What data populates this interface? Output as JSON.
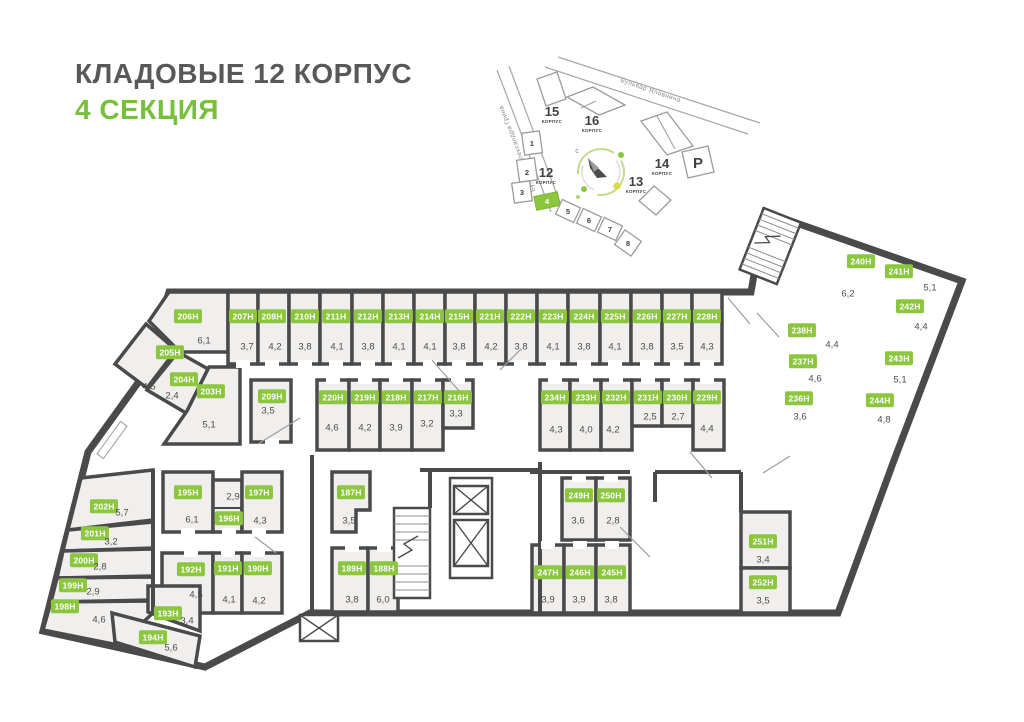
{
  "header": {
    "title": "КЛАДОВЫЕ 12 КОРПУС",
    "subtitle": "4 СЕКЦИЯ"
  },
  "colors": {
    "accent_green": "#8cc63f",
    "wall": "#4a4a4a",
    "room_fill": "#f1efed",
    "title_gray": "#57585a"
  },
  "site_map": {
    "streets": [
      {
        "name": "Бульвар Александра Грина"
      },
      {
        "name": "Бульвар Яловнина"
      }
    ],
    "buildings": [
      {
        "num": "15",
        "label": "КОРПУС"
      },
      {
        "num": "16",
        "label": "КОРПУС"
      },
      {
        "num": "14",
        "label": "КОРПУС"
      },
      {
        "num": "13",
        "label": "КОРПУС"
      },
      {
        "num": "12",
        "label": "КОРПУС"
      }
    ],
    "parking": "Р",
    "north": "с",
    "sections": [
      "1",
      "2",
      "3",
      "4",
      "5",
      "6",
      "7",
      "8"
    ],
    "active_section": "4"
  },
  "floorplan": {
    "rooms": [
      {
        "id": "206Н",
        "area": "6,1",
        "bx": 188,
        "by": 316,
        "ax": 204,
        "ay": 341,
        "poly": [
          [
            169,
            292
          ],
          [
            228,
            292
          ],
          [
            228,
            352
          ],
          [
            180,
            352
          ],
          [
            149,
            321
          ]
        ]
      },
      {
        "id": "207Н",
        "area": "3,7",
        "bx": 243,
        "by": 316,
        "ax": 247,
        "ay": 347,
        "rect": [
          228,
          292,
          30,
          72
        ],
        "door": "b"
      },
      {
        "id": "208Н",
        "area": "4,2",
        "bx": 272,
        "by": 316,
        "ax": 275,
        "ay": 347,
        "rect": [
          258,
          292,
          31,
          72
        ],
        "door": "b"
      },
      {
        "id": "210Н",
        "area": "3,8",
        "bx": 305,
        "by": 316,
        "ax": 305,
        "ay": 347,
        "rect": [
          289,
          292,
          31,
          72
        ],
        "door": "b"
      },
      {
        "id": "211Н",
        "area": "4,1",
        "bx": 336,
        "by": 316,
        "ax": 337,
        "ay": 347,
        "rect": [
          320,
          292,
          32,
          72
        ],
        "door": "b"
      },
      {
        "id": "212Н",
        "area": "3,8",
        "bx": 368,
        "by": 316,
        "ax": 368,
        "ay": 347,
        "rect": [
          352,
          292,
          31,
          72
        ],
        "door": "b"
      },
      {
        "id": "213Н",
        "area": "4,1",
        "bx": 399,
        "by": 316,
        "ax": 399,
        "ay": 347,
        "rect": [
          383,
          292,
          31,
          72
        ],
        "door": "b"
      },
      {
        "id": "214Н",
        "area": "4,1",
        "bx": 430,
        "by": 316,
        "ax": 430,
        "ay": 347,
        "rect": [
          414,
          292,
          31,
          72
        ],
        "door": "b"
      },
      {
        "id": "215Н",
        "area": "3,8",
        "bx": 459,
        "by": 316,
        "ax": 459,
        "ay": 347,
        "rect": [
          445,
          292,
          30,
          72
        ],
        "door": "b"
      },
      {
        "id": "221Н",
        "area": "4,2",
        "bx": 490,
        "by": 316,
        "ax": 491,
        "ay": 347,
        "rect": [
          475,
          292,
          31,
          72
        ],
        "door": "b"
      },
      {
        "id": "222Н",
        "area": "3,8",
        "bx": 521,
        "by": 316,
        "ax": 521,
        "ay": 347,
        "rect": [
          506,
          292,
          31,
          72
        ],
        "door": "b"
      },
      {
        "id": "223Н",
        "area": "4,1",
        "bx": 553,
        "by": 316,
        "ax": 553,
        "ay": 347,
        "rect": [
          537,
          292,
          31,
          72
        ],
        "door": "b"
      },
      {
        "id": "224Н",
        "area": "3,8",
        "bx": 584,
        "by": 316,
        "ax": 584,
        "ay": 347,
        "rect": [
          568,
          292,
          32,
          72
        ],
        "door": "b"
      },
      {
        "id": "225Н",
        "area": "4,1",
        "bx": 615,
        "by": 316,
        "ax": 615,
        "ay": 347,
        "rect": [
          600,
          292,
          31,
          72
        ],
        "door": "b"
      },
      {
        "id": "226Н",
        "area": "3,8",
        "bx": 647,
        "by": 316,
        "ax": 647,
        "ay": 347,
        "rect": [
          631,
          292,
          31,
          72
        ],
        "door": "b"
      },
      {
        "id": "227Н",
        "area": "3,5",
        "bx": 677,
        "by": 316,
        "ax": 677,
        "ay": 347,
        "rect": [
          662,
          292,
          30,
          72
        ],
        "door": "b"
      },
      {
        "id": "228Н",
        "area": "4,3",
        "bx": 707,
        "by": 316,
        "ax": 707,
        "ay": 347,
        "rect": [
          692,
          292,
          30,
          72
        ],
        "door": "b"
      },
      {
        "id": "205Н",
        "area": "4,5",
        "bx": 170,
        "by": 352,
        "ax": 149,
        "ay": 387,
        "poly": [
          [
            146,
            324
          ],
          [
            176,
            350
          ],
          [
            147,
            388
          ],
          [
            115,
            364
          ]
        ]
      },
      {
        "id": "204Н",
        "area": "2,4",
        "bx": 184,
        "by": 379,
        "ax": 172,
        "ay": 396,
        "poly": [
          [
            178,
            352
          ],
          [
            208,
            369
          ],
          [
            186,
            413
          ],
          [
            147,
            390
          ]
        ]
      },
      {
        "id": "203Н",
        "area": "5,1",
        "bx": 211,
        "by": 391,
        "ax": 209,
        "ay": 425,
        "poly": [
          [
            209,
            367
          ],
          [
            240,
            367
          ],
          [
            240,
            444
          ],
          [
            164,
            444
          ],
          [
            187,
            411
          ]
        ]
      },
      {
        "id": "209Н",
        "area": "3,5",
        "bx": 272,
        "by": 396,
        "ax": 268,
        "ay": 411,
        "rect": [
          251,
          380,
          40,
          62
        ],
        "door": "b"
      },
      {
        "id": "220Н",
        "area": "4,6",
        "bx": 333,
        "by": 397,
        "ax": 332,
        "ay": 428,
        "rect": [
          317,
          380,
          32,
          70
        ],
        "door": "t"
      },
      {
        "id": "219Н",
        "area": "4,2",
        "bx": 365,
        "by": 397,
        "ax": 365,
        "ay": 428,
        "rect": [
          349,
          380,
          31,
          70
        ],
        "door": "t"
      },
      {
        "id": "218Н",
        "area": "3,9",
        "bx": 396,
        "by": 397,
        "ax": 396,
        "ay": 428,
        "rect": [
          380,
          380,
          32,
          70
        ],
        "door": "t"
      },
      {
        "id": "217Н",
        "area": "3,2",
        "bx": 428,
        "by": 397,
        "ax": 427,
        "ay": 424,
        "rect": [
          412,
          380,
          31,
          70
        ],
        "door": "t"
      },
      {
        "id": "216Н",
        "area": "3,3",
        "bx": 458,
        "by": 397,
        "ax": 456,
        "ay": 414,
        "rect": [
          443,
          380,
          30,
          48
        ],
        "door": "t"
      },
      {
        "id": "234Н",
        "area": "4,3",
        "bx": 555,
        "by": 397,
        "ax": 556,
        "ay": 430,
        "rect": [
          540,
          380,
          30,
          70
        ],
        "door": "t"
      },
      {
        "id": "233Н",
        "area": "4,0",
        "bx": 586,
        "by": 397,
        "ax": 586,
        "ay": 430,
        "rect": [
          570,
          380,
          31,
          70
        ],
        "door": "t"
      },
      {
        "id": "232Н",
        "area": "4,2",
        "bx": 616,
        "by": 397,
        "ax": 613,
        "ay": 430,
        "rect": [
          601,
          380,
          31,
          70
        ],
        "door": "t"
      },
      {
        "id": "231Н",
        "area": "2,5",
        "bx": 648,
        "by": 397,
        "ax": 650,
        "ay": 417,
        "rect": [
          632,
          380,
          30,
          46
        ],
        "door": "t"
      },
      {
        "id": "230Н",
        "area": "2,7",
        "bx": 677,
        "by": 397,
        "ax": 678,
        "ay": 417,
        "rect": [
          662,
          380,
          31,
          46
        ],
        "door": "t"
      },
      {
        "id": "229Н",
        "area": "4,4",
        "bx": 707,
        "by": 397,
        "ax": 707,
        "ay": 429,
        "rect": [
          693,
          380,
          31,
          70
        ],
        "door": "t"
      },
      {
        "id": "240Н",
        "area": "6,2",
        "bx": 861,
        "by": 261,
        "ax": 848,
        "ay": 294,
        "group": "wing",
        "rect": [
          48,
          -11,
          74,
          66
        ]
      },
      {
        "id": "241Н",
        "area": "5,1",
        "bx": 899,
        "by": 271,
        "ax": 930,
        "ay": 288,
        "group": "wing",
        "rect": [
          126,
          -11,
          56,
          38
        ]
      },
      {
        "id": "242Н",
        "area": "4,4",
        "bx": 910,
        "by": 306,
        "ax": 921,
        "ay": 327,
        "group": "wing",
        "rect": [
          128,
          31,
          54,
          32
        ]
      },
      {
        "id": "243Н",
        "area": "5,1",
        "bx": 899,
        "by": 358,
        "ax": 900,
        "ay": 380,
        "group": "wing",
        "rect": [
          132,
          67,
          50,
          42
        ]
      },
      {
        "id": "244Н",
        "area": "4,8",
        "bx": 880,
        "by": 400,
        "ax": 884,
        "ay": 420,
        "group": "wing",
        "rect": [
          126,
          113,
          56,
          43
        ]
      },
      {
        "id": "238Н",
        "area": "4,4",
        "bx": 802,
        "by": 330,
        "ax": 832,
        "ay": 345,
        "group": "wing",
        "poly": [
          [
            28,
            76
          ],
          [
            96,
            76
          ],
          [
            96,
            106
          ],
          [
            36,
            106
          ]
        ]
      },
      {
        "id": "237Н",
        "area": "4,6",
        "bx": 803,
        "by": 361,
        "ax": 815,
        "ay": 379,
        "group": "wing",
        "poly": [
          [
            38,
            110
          ],
          [
            98,
            110
          ],
          [
            98,
            140
          ],
          [
            46,
            140
          ]
        ]
      },
      {
        "id": "236Н",
        "area": "3,6",
        "bx": 799,
        "by": 398,
        "ax": 800,
        "ay": 417,
        "group": "wing",
        "poly": [
          [
            48,
            144
          ],
          [
            100,
            144
          ],
          [
            100,
            178
          ],
          [
            56,
            178
          ]
        ]
      },
      {
        "id": "202Н",
        "area": "5,7",
        "bx": 104,
        "by": 506,
        "ax": 122,
        "ay": 513,
        "poly": [
          [
            81,
            478
          ],
          [
            153,
            470
          ],
          [
            153,
            520
          ],
          [
            68,
            530
          ]
        ]
      },
      {
        "id": "201Н",
        "area": "3,2",
        "bx": 95,
        "by": 533,
        "ax": 111,
        "ay": 542,
        "poly": [
          [
            68,
            530
          ],
          [
            153,
            522
          ],
          [
            153,
            548
          ],
          [
            63,
            551
          ]
        ]
      },
      {
        "id": "200Н",
        "area": "2,8",
        "bx": 84,
        "by": 560,
        "ax": 100,
        "ay": 567,
        "poly": [
          [
            63,
            551
          ],
          [
            153,
            549
          ],
          [
            153,
            576
          ],
          [
            57,
            578
          ]
        ]
      },
      {
        "id": "199Н",
        "area": "2,9",
        "bx": 73,
        "by": 585,
        "ax": 93,
        "ay": 592,
        "poly": [
          [
            57,
            578
          ],
          [
            153,
            577
          ],
          [
            153,
            600
          ],
          [
            51,
            602
          ]
        ]
      },
      {
        "id": "198Н",
        "area": "4,6",
        "bx": 65,
        "by": 606,
        "ax": 99,
        "ay": 620,
        "poly": [
          [
            51,
            602
          ],
          [
            153,
            601
          ],
          [
            153,
            613
          ],
          [
            118,
            645
          ],
          [
            43,
            630
          ]
        ]
      },
      {
        "id": "195Н",
        "area": "6,1",
        "bx": 188,
        "by": 492,
        "ax": 192,
        "ay": 520,
        "rect": [
          163,
          472,
          50,
          60
        ],
        "door": "b"
      },
      {
        "id": "196Н",
        "area": "2,9",
        "bx": 229,
        "by": 518,
        "ax": 233,
        "ay": 497,
        "rect": [
          213,
          480,
          29,
          52
        ],
        "door": "b"
      },
      {
        "id": "197Н",
        "area": "4,3",
        "bx": 259,
        "by": 492,
        "ax": 260,
        "ay": 521,
        "rect": [
          242,
          472,
          40,
          60
        ],
        "door": "b"
      },
      {
        "id": "192Н",
        "area": "4,5",
        "bx": 191,
        "by": 569,
        "ax": 196,
        "ay": 595,
        "rect": [
          162,
          553,
          51,
          60
        ],
        "door": "t"
      },
      {
        "id": "191Н",
        "area": "4,1",
        "bx": 228,
        "by": 568,
        "ax": 229,
        "ay": 600,
        "rect": [
          213,
          553,
          29,
          60
        ],
        "door": "t"
      },
      {
        "id": "190Н",
        "area": "4,2",
        "bx": 258,
        "by": 568,
        "ax": 259,
        "ay": 601,
        "rect": [
          242,
          553,
          40,
          60
        ],
        "door": "t"
      },
      {
        "id": "193Н",
        "area": "3,4",
        "bx": 168,
        "by": 613,
        "ax": 187,
        "ay": 621,
        "poly": [
          [
            148,
            586
          ],
          [
            200,
            586
          ],
          [
            200,
            631
          ],
          [
            148,
            612
          ]
        ]
      },
      {
        "id": "194Н",
        "area": "5,6",
        "bx": 153,
        "by": 637,
        "ax": 171,
        "ay": 648,
        "poly": [
          [
            112,
            613
          ],
          [
            200,
            636
          ],
          [
            195,
            667
          ],
          [
            115,
            642
          ]
        ]
      },
      {
        "id": "187Н",
        "area": "3,5",
        "bx": 351,
        "by": 492,
        "ax": 349,
        "ay": 521,
        "poly": [
          [
            332,
            472
          ],
          [
            370,
            472
          ],
          [
            370,
            510
          ],
          [
            356,
            510
          ],
          [
            356,
            532
          ],
          [
            332,
            532
          ]
        ]
      },
      {
        "id": "189Н",
        "area": "3,8",
        "bx": 352,
        "by": 568,
        "ax": 352,
        "ay": 600,
        "rect": [
          332,
          548,
          36,
          64
        ],
        "door": "t"
      },
      {
        "id": "188Н",
        "area": "6,0",
        "bx": 384,
        "by": 568,
        "ax": 383,
        "ay": 600,
        "rect": [
          368,
          548,
          30,
          64
        ],
        "door": "t"
      },
      {
        "id": "249Н",
        "area": "3,6",
        "bx": 579,
        "by": 495,
        "ax": 578,
        "ay": 521,
        "rect": [
          562,
          478,
          34,
          62
        ],
        "door": "t"
      },
      {
        "id": "250Н",
        "area": "2,8",
        "bx": 611,
        "by": 495,
        "ax": 613,
        "ay": 521,
        "rect": [
          596,
          478,
          34,
          62
        ],
        "door": "t"
      },
      {
        "id": "247Н",
        "area": "3,9",
        "bx": 548,
        "by": 572,
        "ax": 548,
        "ay": 600,
        "rect": [
          532,
          545,
          32,
          68
        ],
        "door": "t"
      },
      {
        "id": "246Н",
        "area": "3,9",
        "bx": 580,
        "by": 572,
        "ax": 579,
        "ay": 600,
        "rect": [
          564,
          545,
          32,
          68
        ],
        "door": "t"
      },
      {
        "id": "245Н",
        "area": "3,8",
        "bx": 612,
        "by": 572,
        "ax": 611,
        "ay": 600,
        "rect": [
          596,
          545,
          34,
          68
        ],
        "door": "t"
      },
      {
        "id": "251Н",
        "area": "3,4",
        "bx": 763,
        "by": 541,
        "ax": 763,
        "ay": 560,
        "rect": [
          741,
          512,
          49,
          56
        ]
      },
      {
        "id": "252Н",
        "area": "3,5",
        "bx": 763,
        "by": 582,
        "ax": 763,
        "ay": 601,
        "rect": [
          741,
          568,
          49,
          45
        ]
      }
    ]
  }
}
